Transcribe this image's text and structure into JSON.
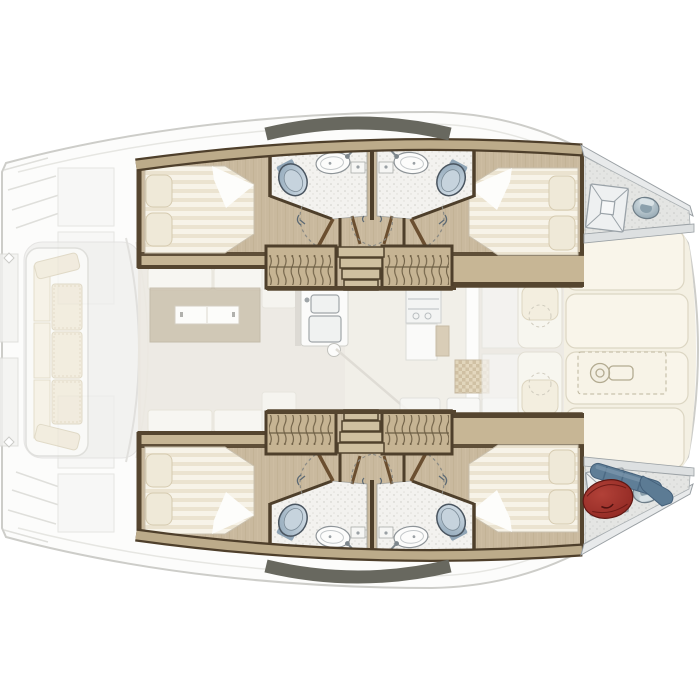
{
  "document": {
    "kind": "boat-floor-plan",
    "subject": "catamaran-interior",
    "view": "top-down",
    "orientation": "bow-right-stern-left"
  },
  "palette": {
    "background": "#ffffff",
    "ghost_line": "#cfcfcb",
    "hull_wood_floor": "#c9b99e",
    "trim_dark_wood": "#55452f",
    "trim_tan": "#bcab8a",
    "coachroof_band_grey": "#68685f",
    "mattress": "#f7f3e8",
    "mattress_stripe": "#ebe3d0",
    "pillow_cream": "#efe9d8",
    "bathroom_floor": "#f3f2ef",
    "toilet_blue_grey": "#9db2c4",
    "sink_white": "#fcfcfb",
    "foredeck_panel_ivory": "#f9f5ea",
    "bow_locker_grey": "#e4e5e3",
    "winch_grey": "#a9bac4",
    "gear_bag_red": "#9c2e28",
    "fender_blue": "#5f7e97",
    "cockpit_cushion": "#efe8d6"
  },
  "inventory": {
    "hulls": 2,
    "double_beds": 4,
    "bathrooms": 4,
    "toilets": 4,
    "washbasins": 4,
    "wardrobes": 4,
    "companionway_stairs": 2,
    "bow_escape_hatches": 2,
    "bow_winches": 2,
    "saloon": [
      "dining-table",
      "folding-table-leaf",
      "sofa-cushions",
      "galley-double-sink",
      "cooktop",
      "tiled-worktop",
      "forward-door-mullion"
    ],
    "cockpit": [
      "aft-bench-3-cushions",
      "angled-end-cushions",
      "transom-lockers",
      "swim-steps"
    ],
    "foredeck": [
      "deck-panels-4",
      "windlass-dashed-outline",
      "lounge-pads-2"
    ],
    "bow_stowage": [
      "red-gear-bag",
      "fender-long",
      "fender-cone"
    ]
  }
}
